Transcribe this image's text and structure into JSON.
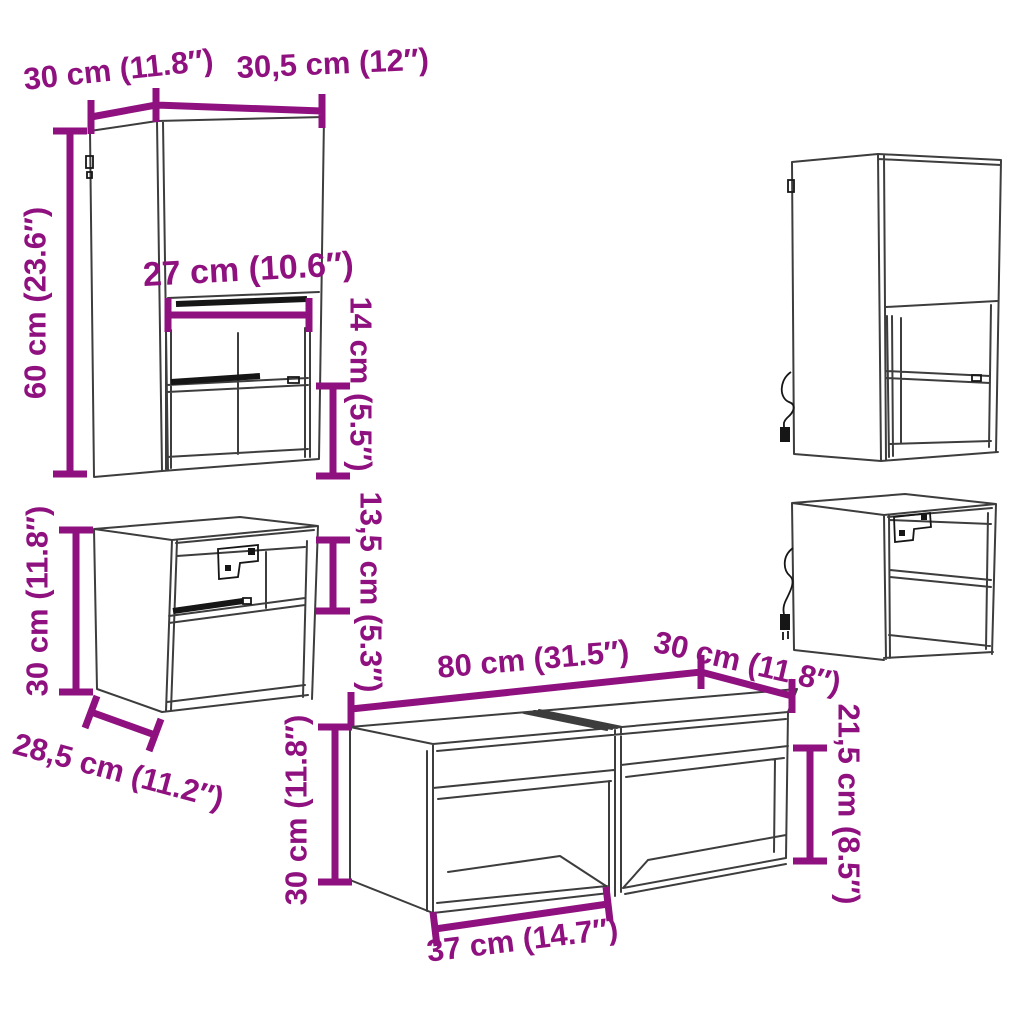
{
  "meta": {
    "image_type": "furniture dimension diagram",
    "units": "cm / inches"
  },
  "colors": {
    "dimension": "#8F117F",
    "line": "#3D3D3D",
    "detail": "#161616",
    "background": "#FFFFFF"
  },
  "labels": {
    "tall_cabinet": {
      "depth": "30 cm (11.8″)",
      "width": "30,5 cm (12″)",
      "height": "60 cm (23.6″)",
      "opening_width": "27 cm (10.6″)",
      "opening_height": "14 cm (5.5″)"
    },
    "small_cabinet": {
      "height": "30 cm (11.8″)",
      "opening_height": "13,5 cm (5.3″)",
      "depth": "28,5 cm (11.2″)"
    },
    "bench": {
      "height": "30 cm (11.8″)",
      "width": "80 cm (31.5″)",
      "depth": "30 cm (11.8″)",
      "side_height": "21,5 cm (8.5″)",
      "opening_width": "37 cm (14.7″)"
    }
  }
}
